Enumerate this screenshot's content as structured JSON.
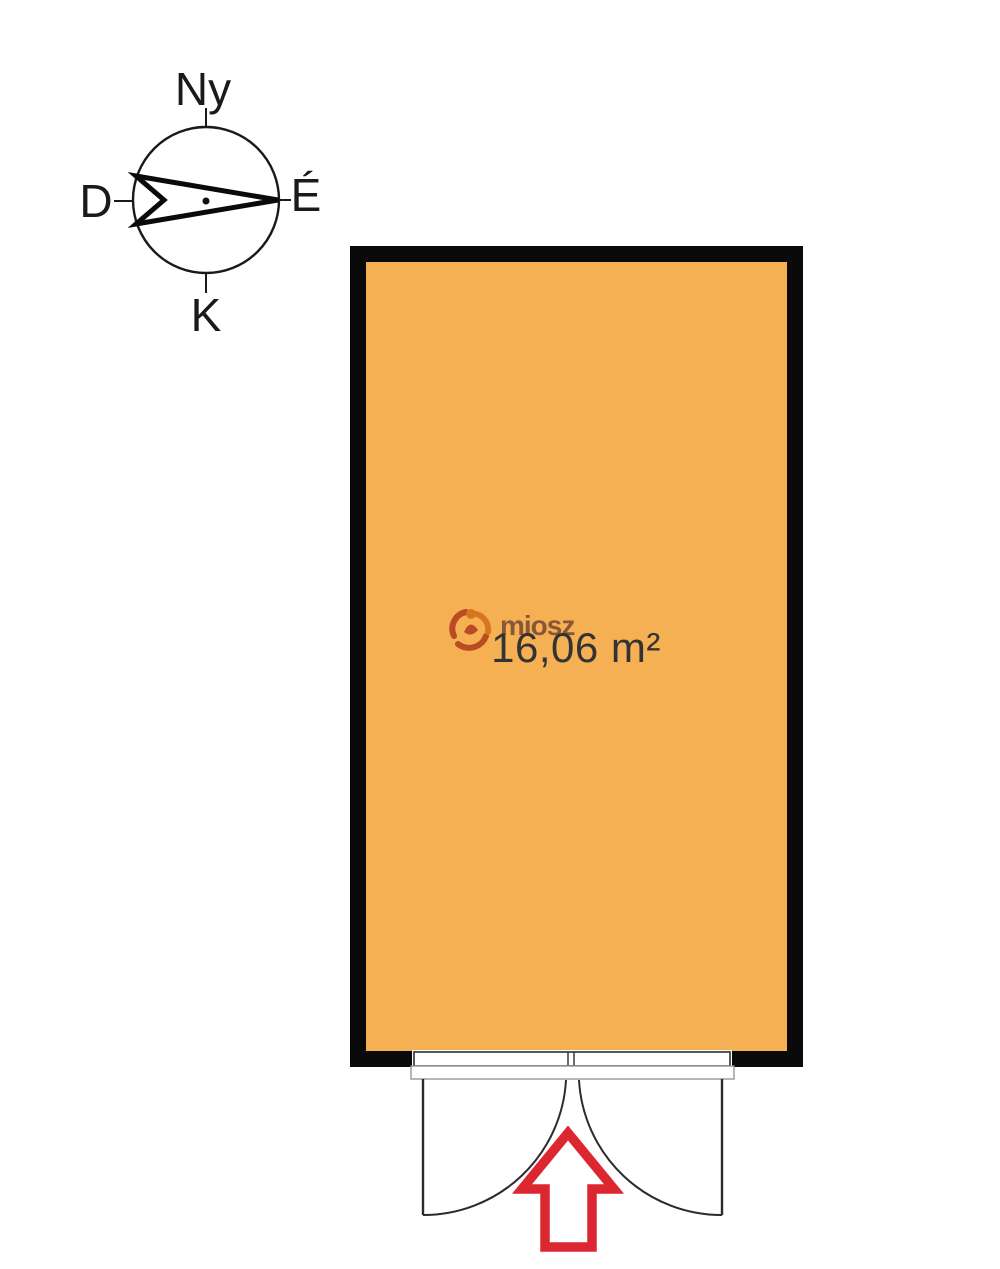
{
  "compass": {
    "label_top": "Ny",
    "label_right": "É",
    "label_left": "D",
    "label_bottom": "K"
  },
  "room": {
    "area_label": "16,06 m²"
  },
  "watermark": {
    "text": "miosz"
  },
  "colors": {
    "room_fill": "#F6B054",
    "wall_black": "#0a0a0a",
    "line_dark": "#2b2b2b",
    "arrow_red": "#DC2630",
    "area_text": "#333333",
    "watermark_text": "#6A3F2F",
    "watermark_orange": "#D4731C",
    "watermark_red": "#B5431E"
  }
}
